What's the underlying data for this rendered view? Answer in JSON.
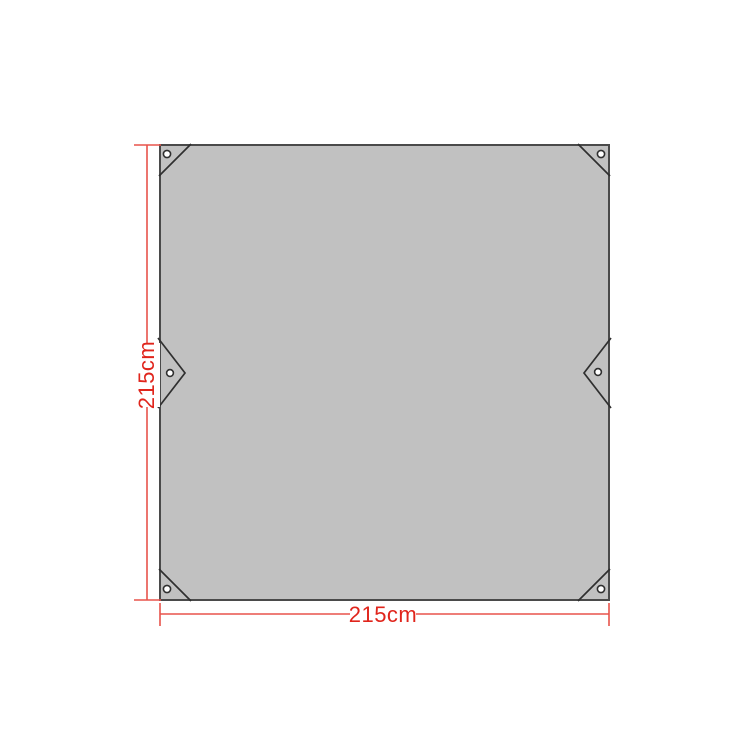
{
  "diagram": {
    "title": "tarp-dimension-diagram",
    "subject": "Square tarp top view with corner grommets, corner reinforcement seams and side tie-out tabs",
    "width_label": "215cm",
    "height_label": "215cm"
  },
  "colors": {
    "background": "#ffffff",
    "tarp_fill": "#c1c1c1",
    "tarp_border": "#4a4a4a",
    "detail_line": "#2f2f2f",
    "grommet_fill": "#ffffff",
    "dimension_line": "#e8534b",
    "dimension_text": "#e0251c"
  }
}
